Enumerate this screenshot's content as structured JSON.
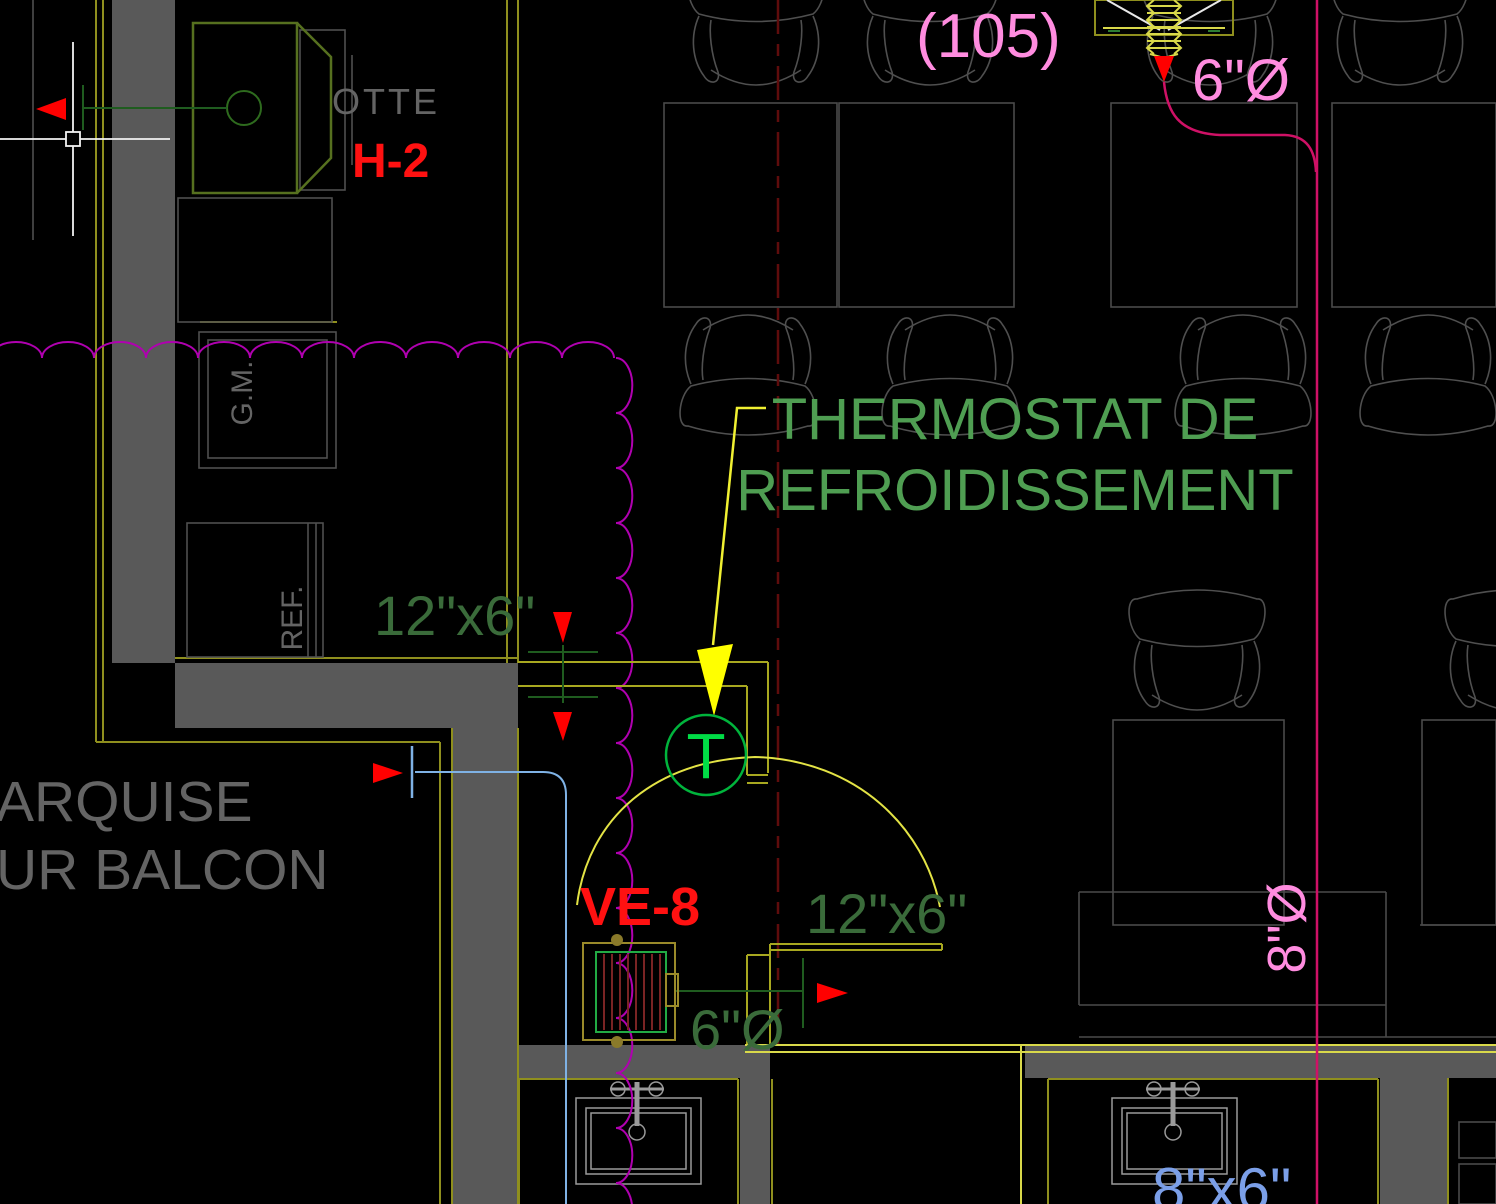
{
  "annotations": {
    "hood_label_partial": "OTTE",
    "hood_tag": "H-2",
    "room_number": "(105)",
    "flex_duct_size": "6\"Ø",
    "thermostat_note_line1": "THERMOSTAT DE",
    "thermostat_note_line2": "REFROIDISSEMENT",
    "thermostat_symbol": "T",
    "duct_size_upper": "12\"x6\"",
    "duct_size_lower": "12\"x6\"",
    "exhaust_duct_size": "6\"Ø",
    "round_duct_size": "8\"Ø",
    "rect_duct_size": "8\"x6\"",
    "fan_tag": "VE-8",
    "equipment_gm": "G.M.",
    "equipment_ref": "REF.",
    "balcony_note_line1": "ARQUISE",
    "balcony_note_line2": "UR BALCON"
  },
  "colors": {
    "background": "#000000",
    "wall_fill": "#595959",
    "outline_gray": "#4a4a4a",
    "text_gray": "#646464",
    "annotation_green": "#4f9e52",
    "duct_text_green": "#3a6b3a",
    "tag_red": "#ff1111",
    "bright_yellow": "#f0f032",
    "olive_duct": "#a8a820",
    "balcony_olive": "#8f8f1e",
    "revision_magenta": "#b000b0",
    "pipe_crimson": "#cf1166",
    "label_pink": "#ff8cdf",
    "water_blue": "#7fb2e5",
    "duct_label_blue": "#7b9fe8",
    "thermostat_green": "#00dc46",
    "centerline_red": "#5f0c0c",
    "hood_green": "#56701f",
    "hatch_maroon": "#7a2424",
    "crosshair_white": "#f2f2f2"
  }
}
